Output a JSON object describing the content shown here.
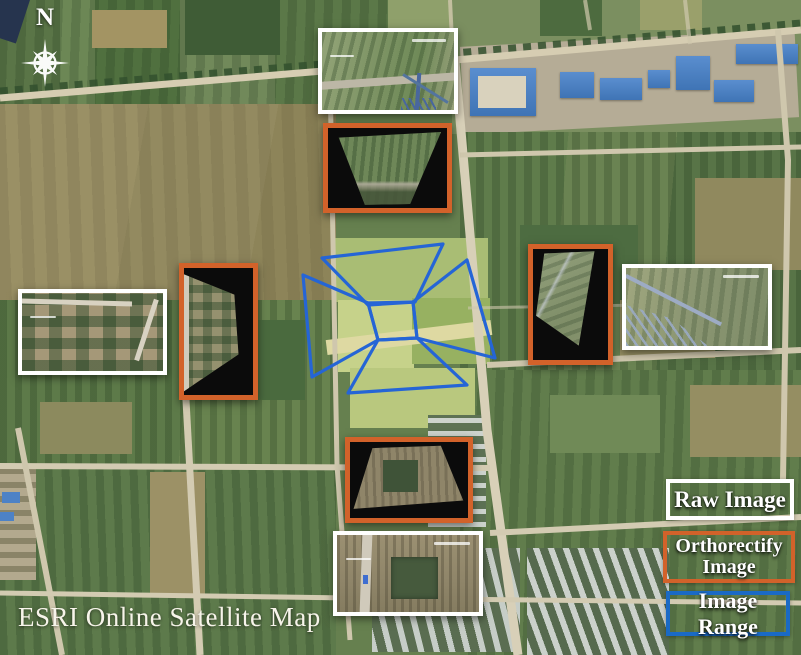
{
  "figure": {
    "credit": "ESRI Online Satellite Map"
  },
  "compass": {
    "label": "N"
  },
  "legend": {
    "items": [
      {
        "label": "Raw Image",
        "border_color": "#ffffff"
      },
      {
        "label": "Orthorectify Image",
        "border_color": "#d2622a"
      },
      {
        "label": "Image Range",
        "border_color": "#1a6ac5"
      }
    ]
  },
  "overlay": {
    "image_range_stroke": "#2565d6",
    "range_polygon_count": 5,
    "raw_inset_count": 4,
    "ortho_inset_count": 4
  }
}
